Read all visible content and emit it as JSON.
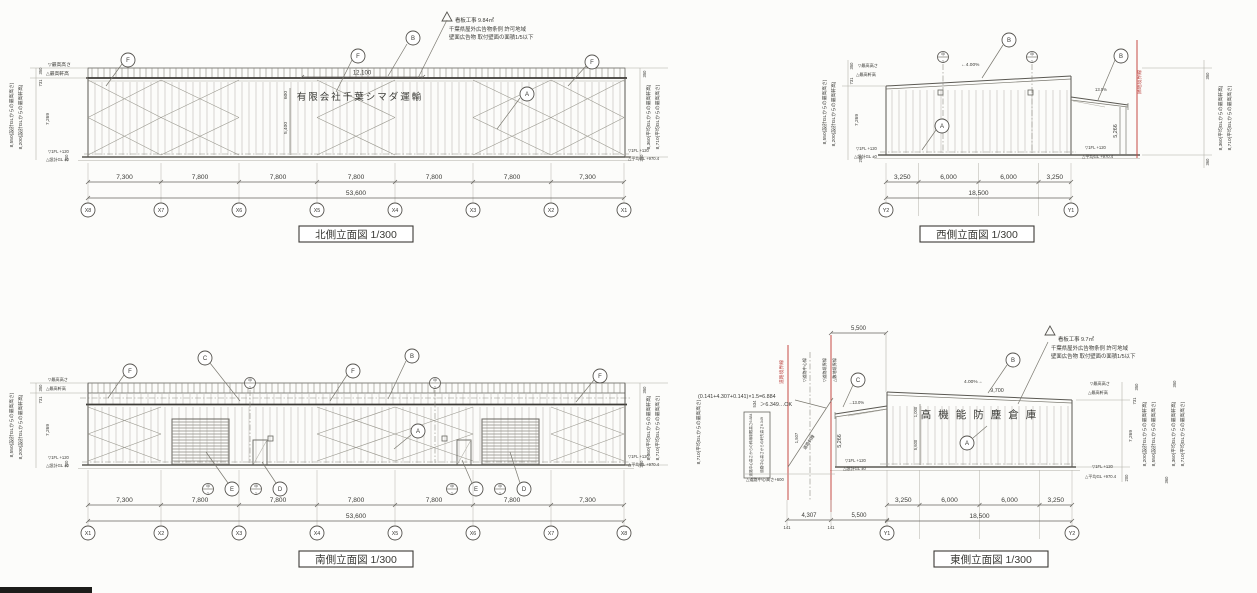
{
  "common": {
    "max_h": "▽最高高さ",
    "max_e": "△最高軒高",
    "fl": "▽1FL +120",
    "dgl": "△設計GL ±0",
    "agl": "△平均GL +970.4",
    "h8550": "8,550(設計GLからの最高高さ)",
    "h8200": "8,200(設計GLからの最高軒高)",
    "h8360": "8,360(平均GLからの最高軒高)",
    "h8710": "8,710(平均GLからの最高高さ)",
    "d350": "350",
    "d731": "731",
    "d7269": "7,269",
    "d200": "200",
    "d360": "360",
    "datum_t": "甲",
    "datum_b": "1"
  },
  "north": {
    "title": "北側立面図 1/300",
    "note1": "看板工事 9.84㎡",
    "note2": "千葉県屋外広告物条例 許可地域",
    "note3": "壁面広告物 取付壁面の面積1/5以下",
    "sign": "有限会社千葉シマダ運輸",
    "sign_w": "12,100",
    "sign_h1": "600",
    "sign_h2": "5,400",
    "dims": [
      "7,300",
      "7,800",
      "7,800",
      "7,800",
      "7,800",
      "7,800",
      "7,300"
    ],
    "total": "53,600",
    "grids": [
      "X8",
      "X7",
      "X6",
      "X5",
      "X4",
      "X3",
      "X2",
      "X1"
    ],
    "c_f": "F",
    "c_b": "B",
    "c_a": "A"
  },
  "west": {
    "title": "西側立面図 1/300",
    "slope": "←4.00%",
    "canopy_slope": "13.0%",
    "wall_h": "5,266",
    "boundary": "隣地境界線",
    "dims": [
      "3,250",
      "6,000",
      "6,000",
      "3,250"
    ],
    "total": "18,500",
    "grids": [
      "Y2",
      "Y1"
    ],
    "c_b": "B",
    "c_a": "A"
  },
  "south": {
    "title": "南側立面図 1/300",
    "dims": [
      "7,300",
      "7,800",
      "7,800",
      "7,800",
      "7,800",
      "7,800",
      "7,300"
    ],
    "total": "53,600",
    "grids": [
      "X1",
      "X2",
      "X3",
      "X4",
      "X5",
      "X6",
      "X7",
      "X8"
    ],
    "c_f": "F",
    "c_c": "C",
    "c_b": "B",
    "c_a": "A",
    "c_e": "E",
    "c_d": "D"
  },
  "east": {
    "title": "東側立面図 1/300",
    "note1": "看板工事 9.7㎡",
    "note2": "千葉県屋外広告物条例 許可地域",
    "note3": "壁面広告物 取付壁面の面積1/5以下",
    "sign": "高機能防塵倉庫",
    "formula1": "(0.141+4.307+0.141)×1.5=6.884",
    "formula2": "＞6.349…OK",
    "box1": "道路中心高さからの斜線制限高さ6.884",
    "box2": "道路中心高さからの軒先高さ6.349",
    "slant": "道路斜線",
    "slant_dim": "1,507",
    "diff": "534",
    "road_gl": "△道路中心高さ+600",
    "b_road": "道路境界線",
    "b_center": "▽道路中心線",
    "b_road2": "▽道路境界線",
    "b_site": "△敷地境界線",
    "canopy_slope": "→13.0%",
    "slope": "4.00%→",
    "sign_w": "9,700",
    "sign_h1": "1,000",
    "sign_h2": "5,600",
    "wall_h": "5,266",
    "top_dim": "5,500",
    "d141": "141",
    "d4307": "4,307",
    "d5500": "5,500",
    "dims": [
      "3,250",
      "6,000",
      "6,000",
      "3,250"
    ],
    "total": "18,500",
    "grids": [
      "Y1",
      "Y2"
    ],
    "c_c": "C",
    "c_b": "B",
    "c_a": "A"
  }
}
